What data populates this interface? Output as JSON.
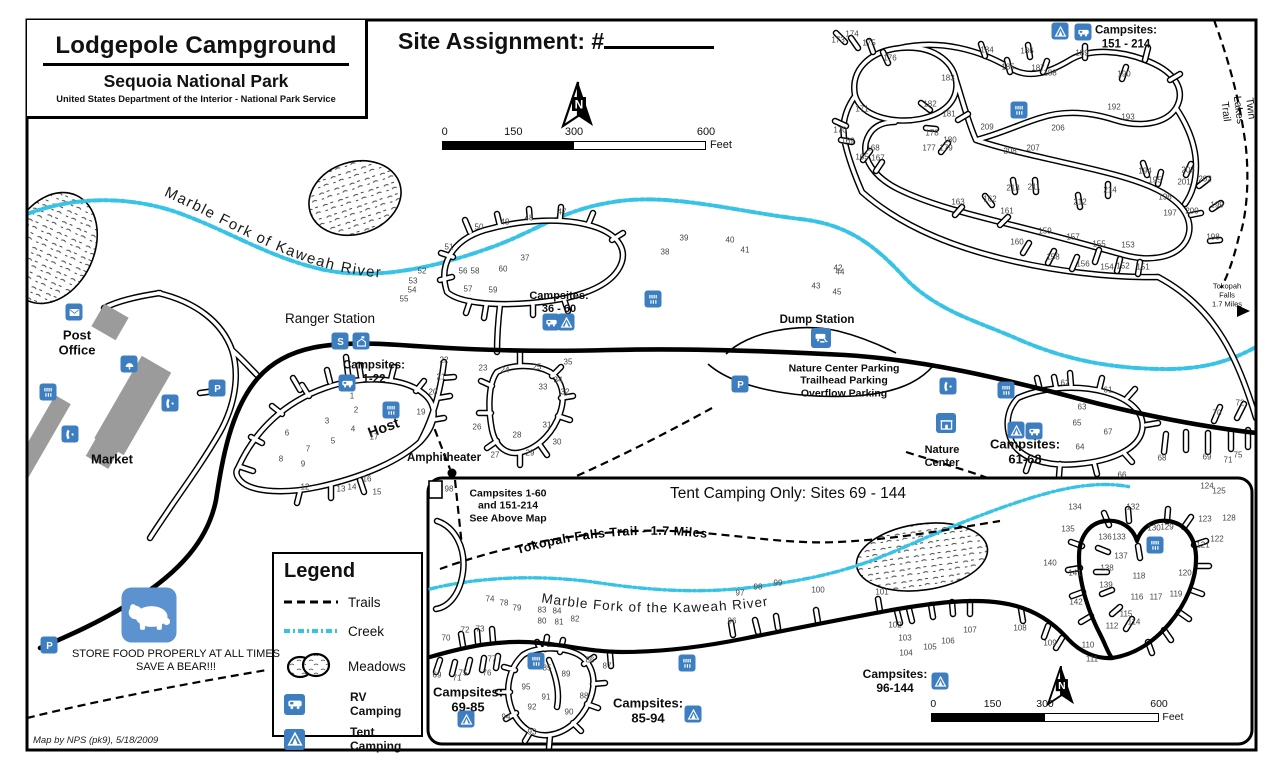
{
  "header": {
    "title": "Lodgepole Campground",
    "subtitle": "Sequoia National Park",
    "agency": "United States Department of the Interior - National Park Service"
  },
  "site_assignment": {
    "label": "Site Assignment:  #"
  },
  "scale_bar": {
    "ticks": [
      "0",
      "150",
      "300",
      "600"
    ],
    "unit": "Feet"
  },
  "legend": {
    "title": "Legend",
    "items": [
      {
        "sample": "trail",
        "label": "Trails"
      },
      {
        "sample": "creek",
        "label": "Creek"
      },
      {
        "sample": "meadow",
        "label": "Meadows"
      },
      {
        "sample": "rv",
        "label": "RV Camping"
      },
      {
        "sample": "tent",
        "label": "Tent Camping"
      }
    ]
  },
  "curved_labels": {
    "river_upper": "Marble Fork of Kaweah River",
    "river_inset": "Marble Fork of the Kaweah River",
    "tokopah_trail": "Tokopah Falls Trail - 1.7 Miles"
  },
  "footer": {
    "credit": "Map by NPS (pk9), 5/18/2009"
  },
  "colors": {
    "creek": "#36c3e6",
    "icon_blue": "#3c7ebf",
    "bear_blue": "#5b92cf",
    "building_gray": "#9b9b9b"
  },
  "labels": [
    {
      "n": "ranger-station-label",
      "t": "Ranger Station",
      "x": 330,
      "y": 319,
      "fs": 13.5,
      "fw": 400
    },
    {
      "n": "post-office-label",
      "t": "Post\nOffice",
      "x": 77,
      "y": 343,
      "fs": 13,
      "fw": 700
    },
    {
      "n": "market-label",
      "t": "Market",
      "x": 112,
      "y": 459,
      "fs": 13,
      "fw": 700
    },
    {
      "n": "campsites-1-22-label",
      "t": "Campsites:\n1-22",
      "x": 374,
      "y": 373,
      "fs": 11.5,
      "fw": 700
    },
    {
      "n": "host-label",
      "t": "Host",
      "x": 384,
      "y": 429,
      "fs": 14.5,
      "fw": 700,
      "r": -20
    },
    {
      "n": "amphitheater-label",
      "t": "Amphitheater",
      "x": 444,
      "y": 459,
      "fs": 11.5,
      "fw": 700
    },
    {
      "n": "campsites-36-60-label",
      "t": "Campsites:\n36 - 60",
      "x": 559,
      "y": 303,
      "fs": 11,
      "fw": 700
    },
    {
      "n": "dump-station-label",
      "t": "Dump Station",
      "x": 817,
      "y": 321,
      "fs": 11.5,
      "fw": 700
    },
    {
      "n": "parking-areas-label",
      "t": "Nature Center Parking\nTrailhead Parking\nOverflow Parking",
      "x": 844,
      "y": 381,
      "fs": 10.5,
      "fw": 700
    },
    {
      "n": "nature-center-label",
      "t": "Nature\nCenter",
      "x": 942,
      "y": 457,
      "fs": 11,
      "fw": 700
    },
    {
      "n": "campsites-61-68-label",
      "t": "Campsites:\n61-68",
      "x": 1025,
      "y": 452,
      "fs": 13,
      "fw": 700
    },
    {
      "n": "campsites-151-214-label",
      "t": "Campsites:\n151 - 214",
      "x": 1126,
      "y": 38,
      "fs": 11.5,
      "fw": 700
    },
    {
      "n": "twin-lakes-trail-label",
      "t": "Twin Lakes Trail",
      "x": 1238,
      "y": 110,
      "fs": 10.5,
      "fw": 400,
      "r": 83
    },
    {
      "n": "tokopah-falls-label",
      "t": "Tokopah\nFalls\n1.7 Miles",
      "x": 1227,
      "y": 296,
      "fs": 7.5,
      "fw": 400
    },
    {
      "n": "see-above-map-note",
      "t": "Campsites 1-60\nand 151-214\nSee Above Map",
      "x": 508,
      "y": 506,
      "fs": 10.5,
      "fw": 700
    },
    {
      "n": "tent-camping-only-banner",
      "t": "Tent Camping Only: Sites 69 - 144",
      "x": 788,
      "y": 494,
      "fs": 15.5,
      "fw": 400
    },
    {
      "n": "campsites-69-85-label",
      "t": "Campsites:\n69-85",
      "x": 468,
      "y": 700,
      "fs": 13,
      "fw": 700
    },
    {
      "n": "campsites-85-94-label",
      "t": "Campsites:\n85-94",
      "x": 648,
      "y": 711,
      "fs": 13,
      "fw": 700
    },
    {
      "n": "campsites-96-144-label",
      "t": "Campsites:\n96-144",
      "x": 895,
      "y": 681,
      "fs": 12,
      "fw": 700
    },
    {
      "n": "food-storage-warning",
      "t": "STORE FOOD PROPERLY AT ALL TIMES\nSAVE A BEAR!!!",
      "x": 176,
      "y": 661,
      "fs": 11,
      "fw": 400
    }
  ],
  "site_numbers": [
    [
      1,
      352,
      396
    ],
    [
      2,
      356,
      410
    ],
    [
      3,
      327,
      421
    ],
    [
      4,
      353,
      429
    ],
    [
      5,
      333,
      441
    ],
    [
      6,
      287,
      433
    ],
    [
      7,
      308,
      449
    ],
    [
      8,
      281,
      459
    ],
    [
      9,
      303,
      464
    ],
    [
      12,
      305,
      487
    ],
    [
      13,
      341,
      489
    ],
    [
      14,
      352,
      487
    ],
    [
      15,
      377,
      492
    ],
    [
      16,
      367,
      479
    ],
    [
      17,
      374,
      437
    ],
    [
      19,
      421,
      412
    ],
    [
      20,
      433,
      392
    ],
    [
      21,
      441,
      377
    ],
    [
      22,
      444,
      360
    ],
    [
      23,
      483,
      368
    ],
    [
      24,
      505,
      370
    ],
    [
      25,
      537,
      367
    ],
    [
      26,
      477,
      427
    ],
    [
      27,
      495,
      455
    ],
    [
      28,
      517,
      435
    ],
    [
      29,
      530,
      453
    ],
    [
      30,
      557,
      442
    ],
    [
      31,
      547,
      425
    ],
    [
      32,
      565,
      392
    ],
    [
      33,
      543,
      387
    ],
    [
      34,
      558,
      380
    ],
    [
      35,
      568,
      362
    ],
    [
      37,
      525,
      258
    ],
    [
      38,
      665,
      252
    ],
    [
      39,
      684,
      238
    ],
    [
      40,
      730,
      240
    ],
    [
      41,
      745,
      250
    ],
    [
      42,
      838,
      268
    ],
    [
      43,
      816,
      286
    ],
    [
      44,
      840,
      272
    ],
    [
      45,
      837,
      292
    ],
    [
      47,
      562,
      212
    ],
    [
      48,
      529,
      218
    ],
    [
      49,
      505,
      222
    ],
    [
      50,
      479,
      227
    ],
    [
      51,
      449,
      247
    ],
    [
      52,
      422,
      271
    ],
    [
      53,
      413,
      281
    ],
    [
      54,
      412,
      290
    ],
    [
      55,
      404,
      299
    ],
    [
      56,
      463,
      271
    ],
    [
      57,
      468,
      289
    ],
    [
      58,
      475,
      271
    ],
    [
      59,
      493,
      290
    ],
    [
      60,
      503,
      269
    ],
    [
      61,
      1108,
      390
    ],
    [
      62,
      1065,
      383
    ],
    [
      63,
      1082,
      407
    ],
    [
      64,
      1080,
      447
    ],
    [
      65,
      1077,
      423
    ],
    [
      66,
      1122,
      475
    ],
    [
      67,
      1108,
      432
    ],
    [
      68,
      1162,
      458
    ],
    [
      69,
      1207,
      457
    ],
    [
      70,
      1217,
      413
    ],
    [
      71,
      1228,
      460
    ],
    [
      72,
      1240,
      403
    ],
    [
      75,
      1238,
      455
    ],
    [
      151,
      1143,
      267
    ],
    [
      152,
      1123,
      266
    ],
    [
      153,
      1128,
      245
    ],
    [
      154,
      1107,
      267
    ],
    [
      155,
      1099,
      244
    ],
    [
      156,
      1083,
      264
    ],
    [
      157,
      1073,
      237
    ],
    [
      158,
      1053,
      257
    ],
    [
      159,
      1045,
      231
    ],
    [
      160,
      1017,
      242
    ],
    [
      161,
      1007,
      211
    ],
    [
      162,
      990,
      199
    ],
    [
      163,
      958,
      202
    ],
    [
      165,
      862,
      157
    ],
    [
      167,
      878,
      158
    ],
    [
      168,
      873,
      148
    ],
    [
      169,
      848,
      141
    ],
    [
      170,
      840,
      130
    ],
    [
      171,
      862,
      109
    ],
    [
      173,
      838,
      40
    ],
    [
      174,
      852,
      34
    ],
    [
      175,
      869,
      43
    ],
    [
      176,
      890,
      58
    ],
    [
      177,
      929,
      148
    ],
    [
      178,
      932,
      133
    ],
    [
      179,
      946,
      148
    ],
    [
      180,
      950,
      140
    ],
    [
      181,
      949,
      114
    ],
    [
      182,
      930,
      104
    ],
    [
      183,
      948,
      78
    ],
    [
      184,
      987,
      50
    ],
    [
      185,
      1008,
      67
    ],
    [
      186,
      1027,
      51
    ],
    [
      187,
      1038,
      68
    ],
    [
      188,
      1050,
      73
    ],
    [
      189,
      1082,
      53
    ],
    [
      190,
      1124,
      74
    ],
    [
      192,
      1114,
      107
    ],
    [
      193,
      1128,
      117
    ],
    [
      194,
      1145,
      171
    ],
    [
      195,
      1155,
      180
    ],
    [
      196,
      1165,
      197
    ],
    [
      197,
      1170,
      213
    ],
    [
      198,
      1213,
      237
    ],
    [
      199,
      1217,
      205
    ],
    [
      200,
      1192,
      211
    ],
    [
      201,
      1184,
      182
    ],
    [
      202,
      1205,
      179
    ],
    [
      203,
      1188,
      170
    ],
    [
      206,
      1058,
      128
    ],
    [
      207,
      1033,
      148
    ],
    [
      208,
      1010,
      151
    ],
    [
      209,
      987,
      127
    ],
    [
      211,
      1034,
      187
    ],
    [
      212,
      1080,
      202
    ],
    [
      213,
      1013,
      188
    ],
    [
      214,
      1110,
      190
    ],
    [
      98,
      449,
      489
    ],
    [
      69,
      437,
      675
    ],
    [
      70,
      446,
      638
    ],
    [
      71,
      457,
      678
    ],
    [
      72,
      465,
      630
    ],
    [
      73,
      480,
      629
    ],
    [
      74,
      490,
      599
    ],
    [
      75,
      463,
      673
    ],
    [
      76,
      487,
      673
    ],
    [
      77,
      492,
      659
    ],
    [
      78,
      504,
      603
    ],
    [
      79,
      517,
      608
    ],
    [
      80,
      542,
      621
    ],
    [
      81,
      559,
      622
    ],
    [
      82,
      575,
      619
    ],
    [
      83,
      542,
      610
    ],
    [
      84,
      557,
      611
    ],
    [
      85,
      547,
      668
    ],
    [
      86,
      590,
      660
    ],
    [
      87,
      607,
      666
    ],
    [
      88,
      584,
      696
    ],
    [
      89,
      566,
      674
    ],
    [
      90,
      569,
      712
    ],
    [
      91,
      546,
      697
    ],
    [
      92,
      532,
      707
    ],
    [
      93,
      532,
      732
    ],
    [
      94,
      506,
      717
    ],
    [
      95,
      526,
      687
    ],
    [
      96,
      732,
      621
    ],
    [
      97,
      740,
      593
    ],
    [
      98,
      758,
      587
    ],
    [
      99,
      778,
      583
    ],
    [
      100,
      818,
      590
    ],
    [
      101,
      882,
      592
    ],
    [
      102,
      895,
      625
    ],
    [
      103,
      905,
      638
    ],
    [
      104,
      906,
      653
    ],
    [
      105,
      930,
      647
    ],
    [
      106,
      948,
      641
    ],
    [
      107,
      970,
      630
    ],
    [
      108,
      1020,
      628
    ],
    [
      109,
      1050,
      643
    ],
    [
      110,
      1088,
      645
    ],
    [
      111,
      1092,
      659
    ],
    [
      112,
      1112,
      626
    ],
    [
      114,
      1134,
      622
    ],
    [
      115,
      1126,
      614
    ],
    [
      116,
      1137,
      597
    ],
    [
      117,
      1156,
      597
    ],
    [
      118,
      1139,
      576
    ],
    [
      119,
      1176,
      594
    ],
    [
      120,
      1185,
      573
    ],
    [
      121,
      1203,
      545
    ],
    [
      122,
      1217,
      539
    ],
    [
      123,
      1205,
      519
    ],
    [
      124,
      1207,
      486
    ],
    [
      125,
      1219,
      491
    ],
    [
      128,
      1229,
      518
    ],
    [
      129,
      1167,
      527
    ],
    [
      130,
      1154,
      528
    ],
    [
      132,
      1133,
      507
    ],
    [
      133,
      1119,
      537
    ],
    [
      134,
      1075,
      507
    ],
    [
      135,
      1068,
      529
    ],
    [
      136,
      1105,
      537
    ],
    [
      137,
      1121,
      556
    ],
    [
      138,
      1107,
      568
    ],
    [
      139,
      1106,
      585
    ],
    [
      140,
      1050,
      563
    ],
    [
      141,
      1075,
      573
    ],
    [
      142,
      1076,
      602
    ]
  ],
  "icons": [
    {
      "type": "envelope",
      "x": 74,
      "y": 312
    },
    {
      "type": "restroom",
      "x": 48,
      "y": 392
    },
    {
      "type": "phone",
      "x": 70,
      "y": 434
    },
    {
      "type": "phone",
      "x": 170,
      "y": 403
    },
    {
      "type": "parking",
      "x": 217,
      "y": 388,
      "glyph": "P"
    },
    {
      "type": "water",
      "x": 129,
      "y": 364
    },
    {
      "type": "shuttle",
      "x": 340,
      "y": 341,
      "glyph": "S"
    },
    {
      "type": "ranger",
      "x": 361,
      "y": 341
    },
    {
      "type": "rv",
      "x": 347,
      "y": 383
    },
    {
      "type": "restroom",
      "x": 391,
      "y": 410
    },
    {
      "type": "restroom",
      "x": 653,
      "y": 299
    },
    {
      "type": "rv",
      "x": 551,
      "y": 322
    },
    {
      "type": "tent",
      "x": 566,
      "y": 322
    },
    {
      "type": "dump",
      "x": 821,
      "y": 338,
      "s": 20
    },
    {
      "type": "parking",
      "x": 740,
      "y": 384,
      "glyph": "P"
    },
    {
      "type": "phone",
      "x": 948,
      "y": 386
    },
    {
      "type": "nature",
      "x": 946,
      "y": 423,
      "s": 20
    },
    {
      "type": "restroom",
      "x": 1006,
      "y": 390
    },
    {
      "type": "tent",
      "x": 1016,
      "y": 430
    },
    {
      "type": "rv",
      "x": 1034,
      "y": 431
    },
    {
      "type": "tent",
      "x": 1060,
      "y": 31
    },
    {
      "type": "rv",
      "x": 1083,
      "y": 32
    },
    {
      "type": "restroom",
      "x": 1019,
      "y": 110
    },
    {
      "type": "parking",
      "x": 49,
      "y": 645,
      "glyph": "P"
    },
    {
      "type": "bear",
      "x": 149,
      "y": 615,
      "s": 55
    },
    {
      "type": "dot",
      "x": 452,
      "y": 473,
      "s": 9
    },
    {
      "type": "tent",
      "x": 466,
      "y": 719
    },
    {
      "type": "restroom",
      "x": 536,
      "y": 661
    },
    {
      "type": "restroom",
      "x": 687,
      "y": 663
    },
    {
      "type": "tent",
      "x": 693,
      "y": 714
    },
    {
      "type": "tent",
      "x": 940,
      "y": 681
    },
    {
      "type": "restroom",
      "x": 1155,
      "y": 545
    }
  ]
}
